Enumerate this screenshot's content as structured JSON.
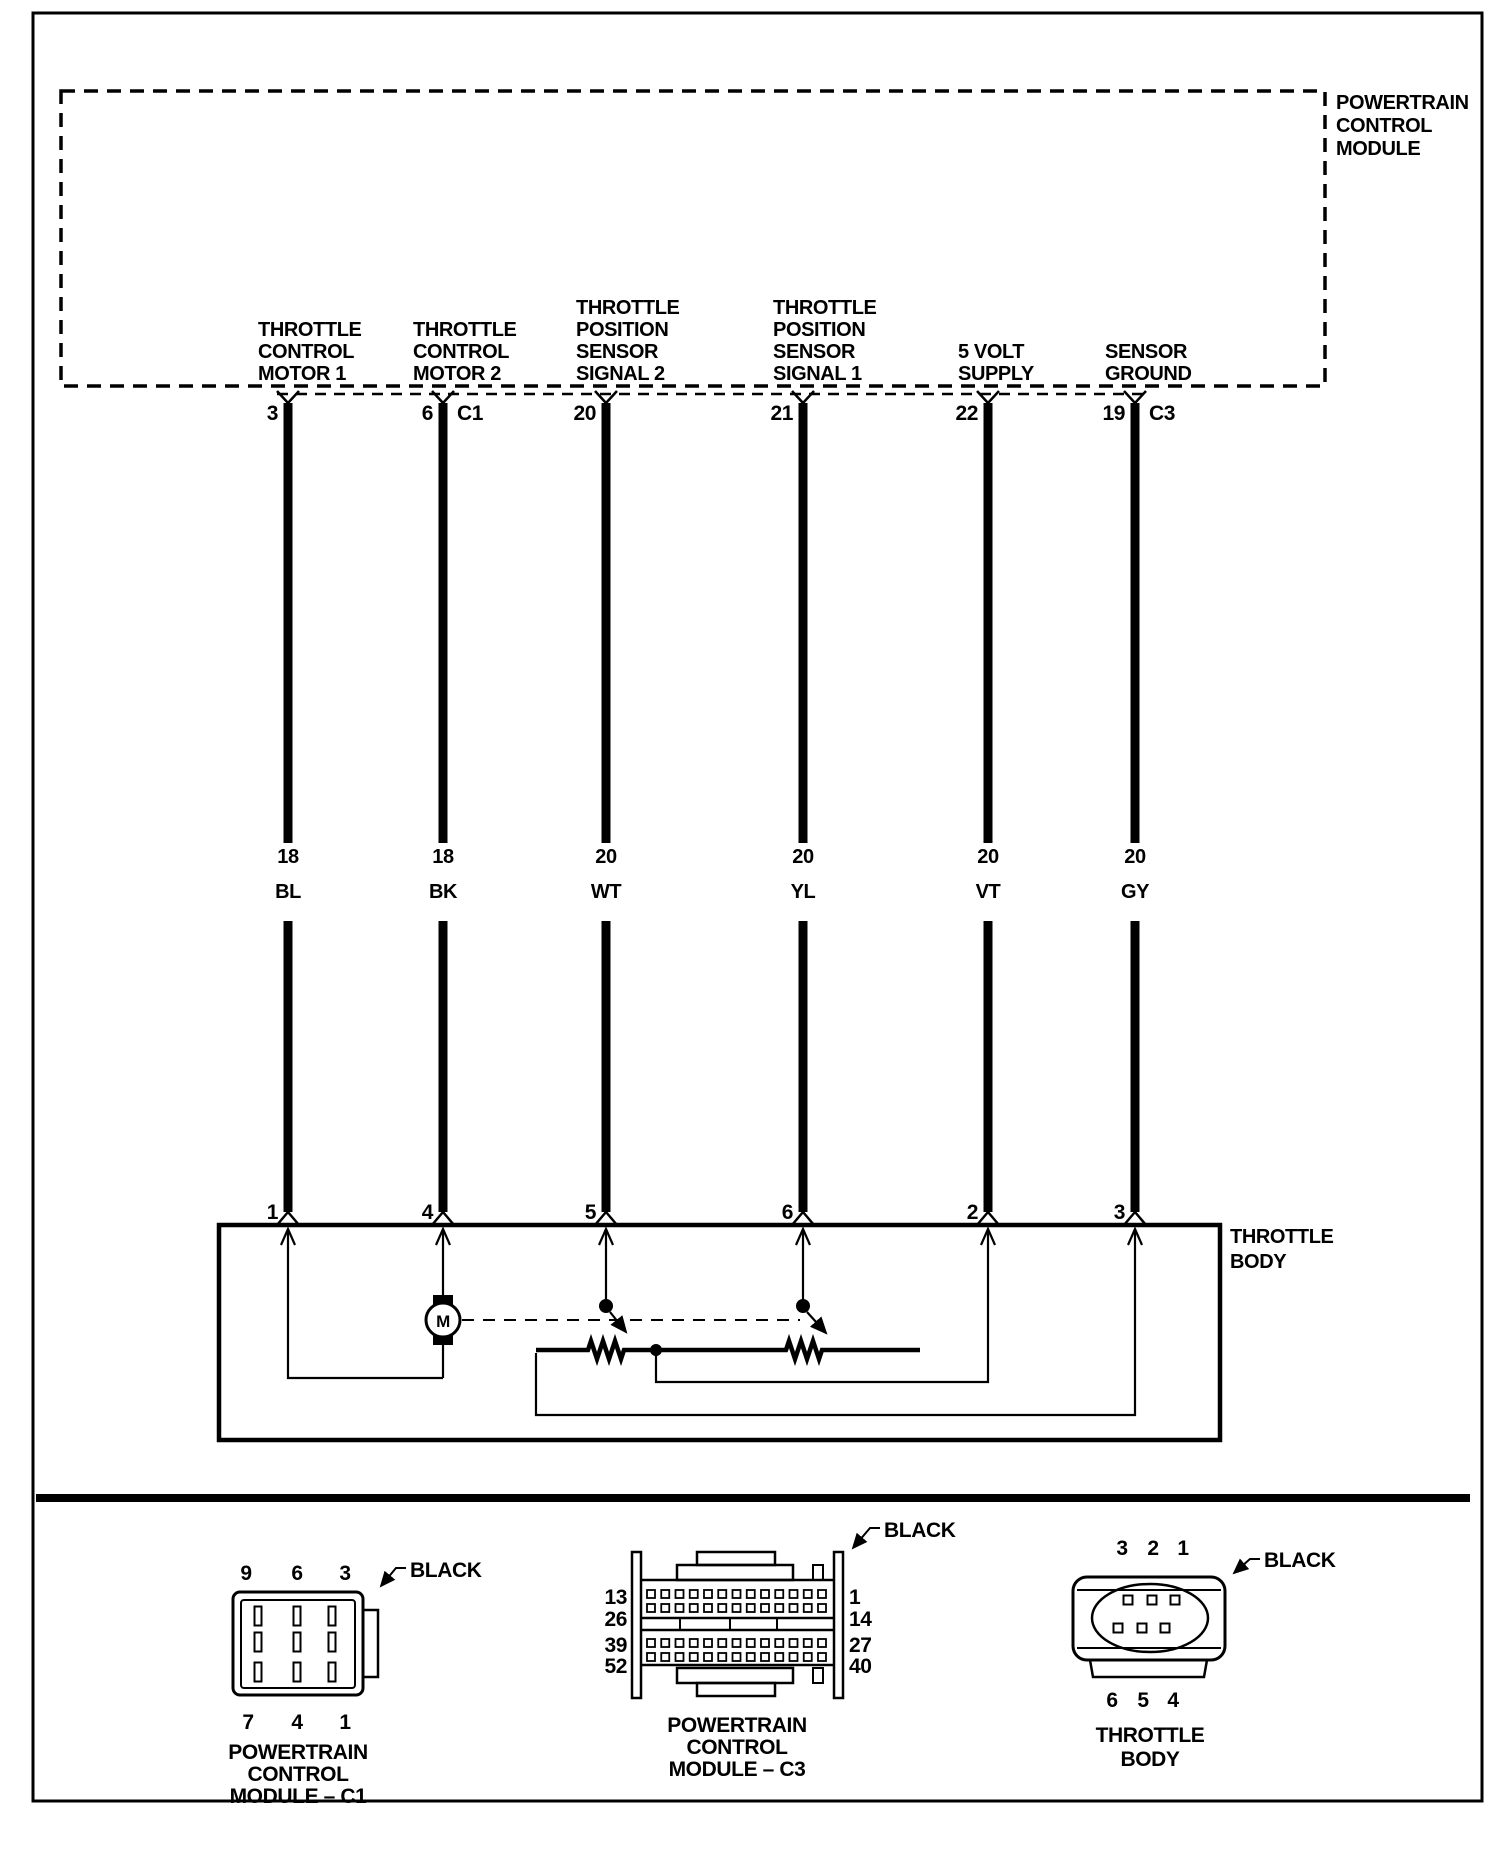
{
  "colors": {
    "ink": "#000000",
    "paper": "#ffffff"
  },
  "pcm": {
    "label_lines": [
      "POWERTRAIN",
      "CONTROL",
      "MODULE"
    ]
  },
  "wires": [
    {
      "name": "throttle-control-motor-1",
      "top_pin": "3",
      "top_connector": "",
      "label_lines": [
        "THROTTLE",
        "CONTROL",
        "MOTOR 1"
      ],
      "gauge": "18",
      "color_code": "BL",
      "bottom_pin": "1"
    },
    {
      "name": "throttle-control-motor-2",
      "top_pin": "6",
      "top_connector": "C1",
      "label_lines": [
        "THROTTLE",
        "CONTROL",
        "MOTOR 2"
      ],
      "gauge": "18",
      "color_code": "BK",
      "bottom_pin": "4"
    },
    {
      "name": "throttle-position-sensor-signal-2",
      "top_pin": "20",
      "top_connector": "",
      "label_lines": [
        "THROTTLE",
        "POSITION",
        "SENSOR",
        "SIGNAL 2"
      ],
      "gauge": "20",
      "color_code": "WT",
      "bottom_pin": "5"
    },
    {
      "name": "throttle-position-sensor-signal-1",
      "top_pin": "21",
      "top_connector": "",
      "label_lines": [
        "THROTTLE",
        "POSITION",
        "SENSOR",
        "SIGNAL 1"
      ],
      "gauge": "20",
      "color_code": "YL",
      "bottom_pin": "6"
    },
    {
      "name": "five-volt-supply",
      "top_pin": "22",
      "top_connector": "",
      "label_lines": [
        "5 VOLT",
        "SUPPLY"
      ],
      "gauge": "20",
      "color_code": "VT",
      "bottom_pin": "2"
    },
    {
      "name": "sensor-ground",
      "top_pin": "19",
      "top_connector": "C3",
      "label_lines": [
        "SENSOR",
        "GROUND"
      ],
      "gauge": "20",
      "color_code": "GY",
      "bottom_pin": "3"
    }
  ],
  "throttle_body": {
    "label_lines": [
      "THROTTLE",
      "BODY"
    ],
    "motor_label": "M"
  },
  "connectors": {
    "c1": {
      "color_label": "BLACK",
      "top_pin_numbers": [
        "9",
        "6",
        "3"
      ],
      "bottom_pin_numbers": [
        "7",
        "4",
        "1"
      ],
      "caption_lines": [
        "POWERTRAIN",
        "CONTROL",
        "MODULE – C1"
      ]
    },
    "c3": {
      "color_label": "BLACK",
      "left_pin_numbers": [
        "13",
        "26",
        "39",
        "52"
      ],
      "right_pin_numbers": [
        "1",
        "14",
        "27",
        "40"
      ],
      "caption_lines": [
        "POWERTRAIN",
        "CONTROL",
        "MODULE – C3"
      ]
    },
    "throttle_body": {
      "color_label": "BLACK",
      "top_pin_numbers": [
        "3",
        "2",
        "1"
      ],
      "bottom_pin_numbers": [
        "6",
        "5",
        "4"
      ],
      "caption_lines": [
        "THROTTLE",
        "BODY"
      ]
    }
  }
}
